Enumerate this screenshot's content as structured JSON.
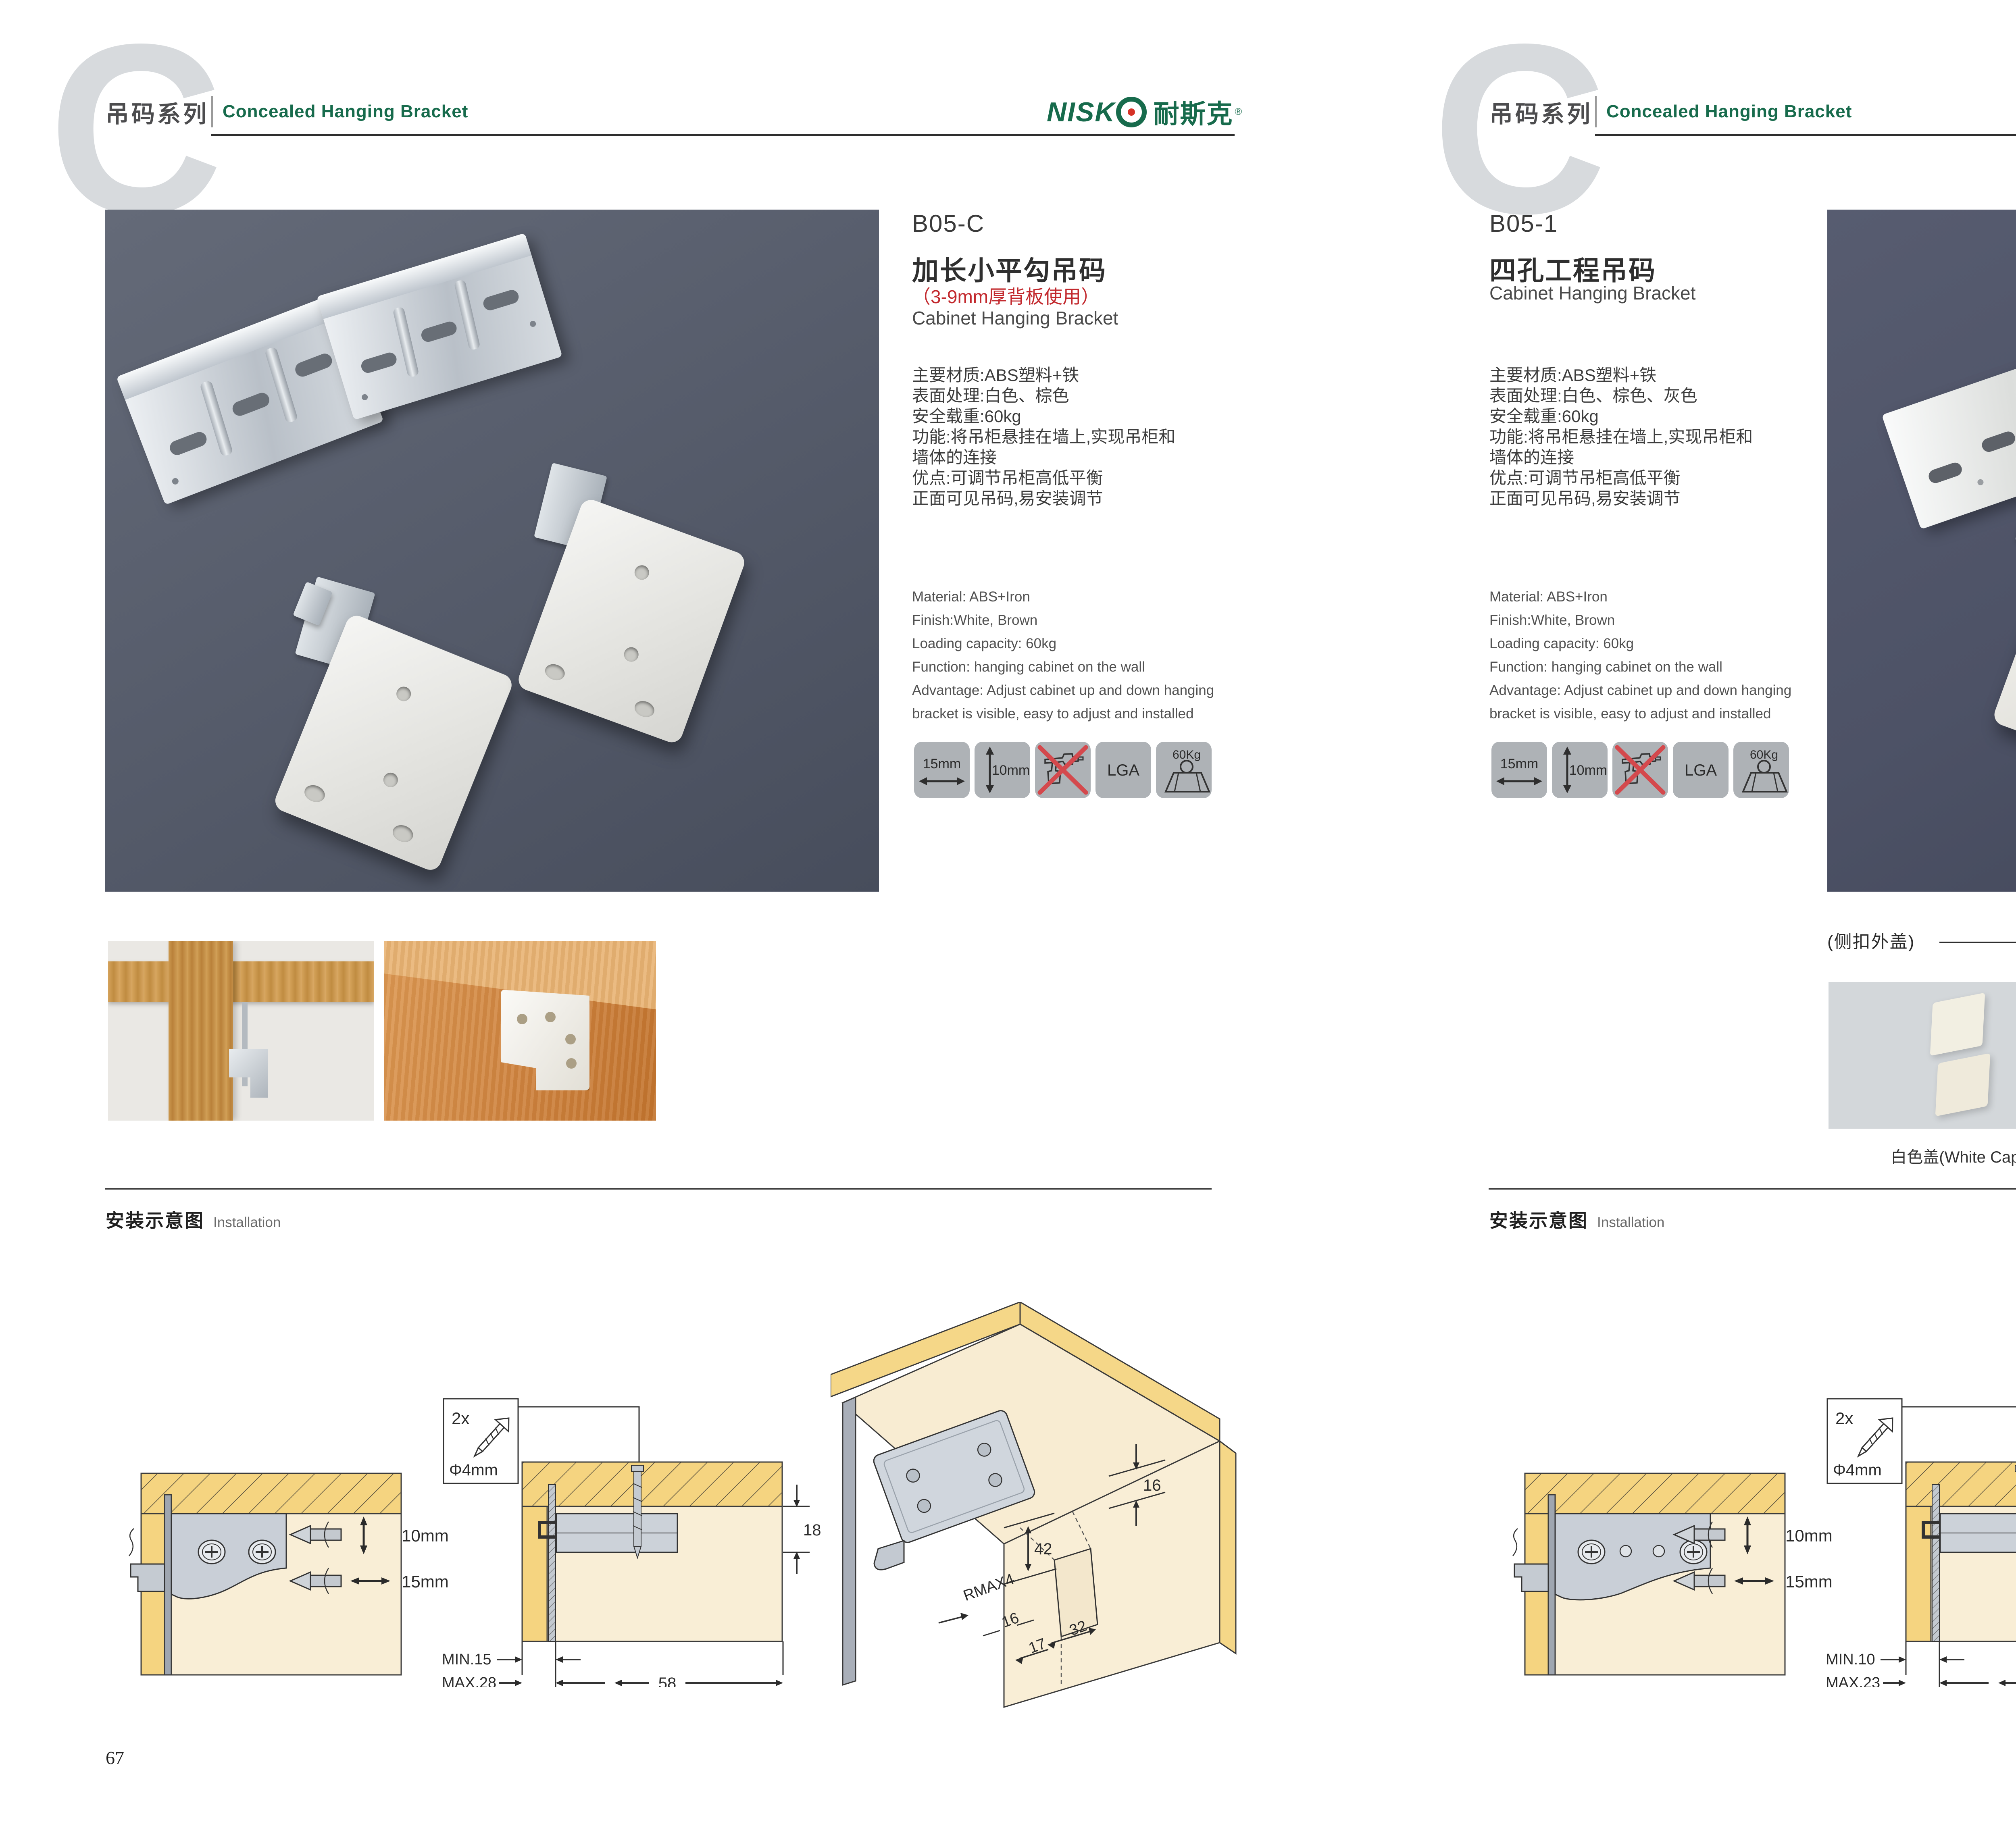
{
  "header": {
    "watermark_letter": "C",
    "series_title_zh": "吊码系列",
    "series_title_en": "Concealed Hanging Bracket",
    "brand": {
      "latin": "NISK",
      "zh": "耐斯克",
      "reg": "®"
    },
    "accent_green": "#176B4C",
    "logo_red": "#D63226"
  },
  "pages": {
    "left": {
      "page_number": "67",
      "product_code": "B05-C",
      "product_title_zh": "加长小平勾吊码",
      "product_subtitle_red": "（3-9mm厚背板使用）",
      "product_title_en": "Cabinet Hanging Bracket",
      "specs_zh": [
        "主要材质:ABS塑料+铁",
        "表面处理:白色、棕色",
        "安全载重:60kg",
        "功能:将吊柜悬挂在墙上,实现吊柜和",
        "墙体的连接",
        "优点:可调节吊柜高低平衡",
        "正面可见吊码,易安装调节"
      ],
      "specs_en": [
        "Material: ABS+Iron",
        "Finish:White, Brown",
        "Loading capacity: 60kg",
        "Function: hanging cabinet on the wall",
        "Advantage: Adjust cabinet up and down hanging",
        "bracket is visible, easy to adjust and installed"
      ],
      "feature_icons": {
        "width_label": "15mm",
        "height_label": "10mm",
        "no_drill_icon": "no-drill-icon",
        "cert_label": "LGA",
        "load_label": "60Kg",
        "load_icon": "weight-icon"
      },
      "installation": {
        "title_zh": "安装示意图",
        "title_en": "Installation"
      },
      "diagram_a": {
        "dim_top": "10mm",
        "dim_bottom": "15mm"
      },
      "diagram_b": {
        "qty": "2x",
        "diameter": "Φ4mm",
        "panel_thickness": "18",
        "min": "MIN.15",
        "max": "MAX.28",
        "spacing": "58"
      },
      "diagram_c": {
        "top_offset": "16",
        "hole_height": "42",
        "radius": "RMAX4",
        "side_offset": "16",
        "pitch": "32",
        "edge_offset": "17"
      }
    },
    "right": {
      "page_number": "68",
      "product_code": "B05-1",
      "product_title_zh": "四孔工程吊码",
      "product_title_en": "Cabinet Hanging Bracket",
      "specs_zh": [
        "主要材质:ABS塑料+铁",
        "表面处理:白色、棕色、灰色",
        "安全载重:60kg",
        "功能:将吊柜悬挂在墙上,实现吊柜和",
        "墙体的连接",
        "优点:可调节吊柜高低平衡",
        "正面可见吊码,易安装调节"
      ],
      "specs_en": [
        "Material: ABS+Iron",
        "Finish:White, Brown",
        "Loading capacity: 60kg",
        "Function: hanging cabinet on the wall",
        "Advantage: Adjust cabinet up and down hanging",
        "bracket is visible, easy to adjust and installed"
      ],
      "feature_icons": {
        "width_label": "15mm",
        "height_label": "10mm",
        "no_drill_icon": "no-drill-icon",
        "cert_label": "LGA",
        "load_label": "60Kg",
        "load_icon": "weight-icon"
      },
      "caps": {
        "section_title": "(侧扣外盖)",
        "items": [
          {
            "label": "白色盖(White Cap)",
            "color": "#f2efe2"
          },
          {
            "label": "灰色盖(Gray Cap)",
            "color": "#b8b4a4"
          },
          {
            "label": "棕色盖(Silver Cap)",
            "color": "#cb6a38"
          }
        ]
      },
      "installation": {
        "title_zh": "安装示意图",
        "title_en": "Installation"
      },
      "diagram_a": {
        "dim_top": "10mm",
        "dim_bottom": "15mm"
      },
      "diagram_b": {
        "qty": "2x",
        "diameter": "Φ4mm",
        "panel_thickness": "18",
        "min": "MIN.10",
        "max": "MAX.23",
        "spacing": "58"
      },
      "diagram_c": {
        "top_offset": "16",
        "hole_height": "42",
        "radius": "RMAX4",
        "side_offset": "16",
        "pitch": "32",
        "edge_offset": "17"
      }
    }
  }
}
